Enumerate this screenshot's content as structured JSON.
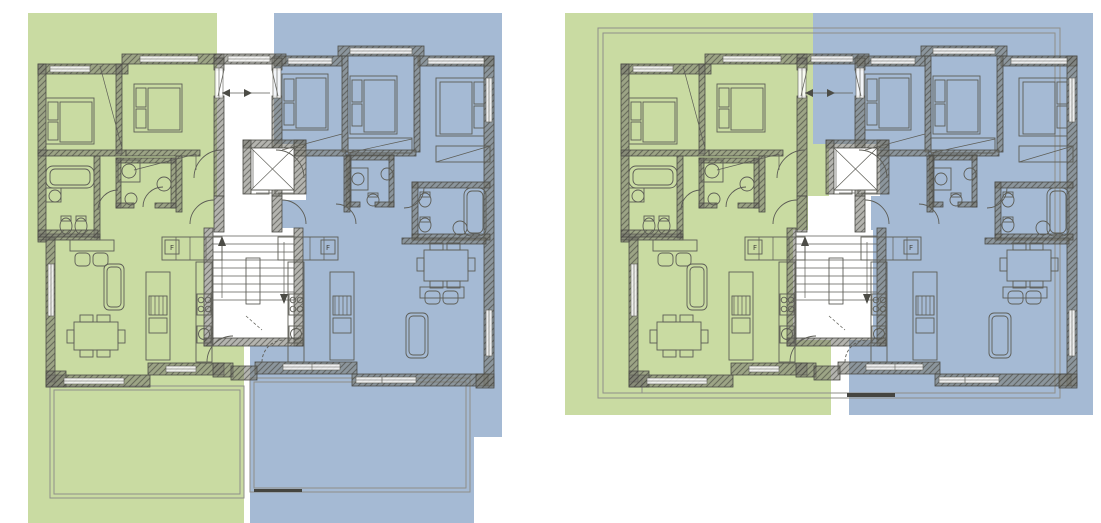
{
  "app": {
    "title": "residential floor plans — two units per level"
  },
  "palette": {
    "page_bg": "#ffffff",
    "unit_a_green": "#c9dba2",
    "unit_b_blue": "#a5bad4",
    "wall_hatch_base": "rgba(118,118,110,0.55)",
    "wall_hatch_line": "rgba(62,62,56,0.55)",
    "wall_stroke": "#4c4c46",
    "line": "#5d5d56",
    "outline_gray": "#8f8f89",
    "dark_line": "#454540",
    "window_fill": "rgba(255,255,255,0.85)",
    "text_color": "#44443f"
  },
  "labels": {
    "fridge": "F"
  },
  "plans": [
    {
      "name": "floor-plan-left",
      "dx": 0,
      "dy": 0,
      "overlay_green": "28,13 217,13 217,196 214,196 214,228 204,228 204,346 244,346 244,523 28,523",
      "overlay_blue": "274,13 502,13 502,437 474,437 474,523 250,523 250,346 303,346 303,228 282,228 282,200 306,200 306,144 274,144",
      "extras": {
        "outline_rects": [],
        "terrace_rects": [
          [
            50,
            386,
            194,
            112
          ],
          [
            54,
            390,
            186,
            104
          ],
          [
            250,
            378,
            220,
            114
          ],
          [
            254,
            382,
            212,
            106
          ]
        ],
        "dark_segments": [
          [
            254,
            489,
            48,
            3
          ]
        ],
        "lines": []
      }
    },
    {
      "name": "floor-plan-right",
      "dx": 583,
      "dy": 0,
      "overlay_green": "565,13 813,13 813,144 829,144 829,196 808,196 808,230 793,230 793,340 831,340 831,415 565,415",
      "overlay_blue": "813,13 1093,13 1093,415 849,415 849,340 873,340 873,230 871,230 871,196 880,196 880,144 813,144",
      "extras": {
        "outline_rects": [
          [
            598,
            28,
            462,
            370
          ],
          [
            603,
            33,
            452,
            360
          ]
        ],
        "terrace_rects": [],
        "dark_segments": [
          [
            847,
            393,
            48,
            4
          ]
        ],
        "lines": [
          [
            642,
            378,
            642,
            393
          ]
        ]
      }
    }
  ],
  "building": {
    "walls": [
      [
        38,
        64,
        90,
        10
      ],
      [
        122,
        54,
        102,
        10
      ],
      [
        214,
        54,
        72,
        10
      ],
      [
        274,
        56,
        68,
        10
      ],
      [
        338,
        46,
        86,
        10
      ],
      [
        418,
        56,
        76,
        10
      ],
      [
        484,
        56,
        10,
        330
      ],
      [
        38,
        64,
        8,
        178
      ],
      [
        46,
        238,
        9,
        144
      ],
      [
        46,
        375,
        104,
        12
      ],
      [
        46,
        371,
        20,
        16
      ],
      [
        148,
        363,
        76,
        12
      ],
      [
        213,
        363,
        20,
        14
      ],
      [
        255,
        362,
        102,
        12
      ],
      [
        231,
        366,
        26,
        14
      ],
      [
        352,
        374,
        136,
        12
      ],
      [
        476,
        374,
        18,
        14
      ],
      [
        214,
        58,
        10,
        12
      ],
      [
        214,
        96,
        10,
        100
      ],
      [
        272,
        58,
        10,
        12
      ],
      [
        272,
        96,
        10,
        100
      ],
      [
        214,
        196,
        10,
        36
      ],
      [
        272,
        196,
        10,
        36
      ],
      [
        204,
        228,
        9,
        118
      ],
      [
        294,
        228,
        9,
        118
      ],
      [
        204,
        338,
        99,
        8
      ],
      [
        243,
        140,
        63,
        8
      ],
      [
        243,
        140,
        8,
        54
      ],
      [
        294,
        140,
        12,
        54
      ],
      [
        116,
        64,
        6,
        90
      ],
      [
        38,
        150,
        88,
        6
      ],
      [
        126,
        150,
        74,
        6
      ],
      [
        94,
        156,
        6,
        82
      ],
      [
        38,
        234,
        62,
        6
      ],
      [
        116,
        158,
        60,
        5
      ],
      [
        116,
        158,
        5,
        50
      ],
      [
        171,
        158,
        5,
        50
      ],
      [
        116,
        203,
        18,
        5
      ],
      [
        155,
        203,
        21,
        5
      ],
      [
        38,
        230,
        60,
        7
      ],
      [
        176,
        156,
        6,
        56
      ],
      [
        342,
        56,
        6,
        96
      ],
      [
        414,
        56,
        6,
        96
      ],
      [
        280,
        150,
        66,
        6
      ],
      [
        348,
        150,
        68,
        6
      ],
      [
        346,
        155,
        48,
        5
      ],
      [
        346,
        155,
        5,
        52
      ],
      [
        389,
        155,
        5,
        52
      ],
      [
        346,
        202,
        14,
        5
      ],
      [
        375,
        202,
        19,
        5
      ],
      [
        412,
        182,
        78,
        6
      ],
      [
        412,
        182,
        6,
        58
      ],
      [
        412,
        234,
        78,
        6
      ],
      [
        402,
        238,
        84,
        6
      ],
      [
        344,
        156,
        6,
        56
      ]
    ],
    "windows": [
      [
        50,
        66,
        40,
        6
      ],
      [
        140,
        56,
        58,
        6
      ],
      [
        228,
        56,
        42,
        6
      ],
      [
        288,
        58,
        44,
        6
      ],
      [
        350,
        48,
        62,
        6
      ],
      [
        428,
        58,
        56,
        6
      ],
      [
        486,
        78,
        6,
        44
      ],
      [
        486,
        310,
        6,
        46
      ],
      [
        48,
        264,
        6,
        52
      ],
      [
        64,
        378,
        60,
        6
      ],
      [
        166,
        366,
        30,
        6
      ],
      [
        283,
        364,
        30,
        6
      ],
      [
        312,
        364,
        28,
        6
      ],
      [
        356,
        377,
        60,
        6
      ],
      [
        215,
        68,
        8,
        30
      ],
      [
        273,
        68,
        8,
        30
      ]
    ],
    "white_rects": [
      [
        251,
        148,
        43,
        42
      ],
      [
        246,
        258,
        14,
        46
      ]
    ],
    "rects": [
      [
        46,
        98,
        48,
        46
      ],
      [
        48,
        102,
        10,
        18
      ],
      [
        48,
        122,
        10,
        18
      ],
      [
        60,
        102,
        32,
        40
      ],
      [
        134,
        84,
        48,
        48
      ],
      [
        136,
        88,
        10,
        19
      ],
      [
        136,
        109,
        10,
        19
      ],
      [
        148,
        88,
        32,
        42
      ],
      [
        282,
        74,
        46,
        56
      ],
      [
        284,
        79,
        10,
        22
      ],
      [
        284,
        103,
        10,
        22
      ],
      [
        296,
        78,
        30,
        50
      ],
      [
        350,
        76,
        47,
        58
      ],
      [
        352,
        80,
        10,
        22
      ],
      [
        352,
        104,
        10,
        22
      ],
      [
        364,
        80,
        31,
        52
      ],
      [
        436,
        78,
        48,
        58
      ],
      [
        474,
        82,
        10,
        22
      ],
      [
        474,
        106,
        10,
        22
      ],
      [
        440,
        82,
        32,
        52
      ],
      [
        348,
        138,
        64,
        15
      ],
      [
        436,
        146,
        54,
        16
      ],
      [
        118,
        160,
        22,
        22
      ],
      [
        348,
        168,
        20,
        22
      ],
      [
        46,
        188,
        15,
        14
      ],
      [
        61,
        216,
        10,
        5
      ],
      [
        76,
        216,
        10,
        5
      ],
      [
        368,
        193,
        10,
        4
      ],
      [
        420,
        192,
        10,
        5
      ],
      [
        420,
        217,
        10,
        5
      ],
      [
        162,
        237,
        60,
        23
      ],
      [
        165,
        240,
        14,
        14
      ],
      [
        146,
        272,
        24,
        88
      ],
      [
        149,
        296,
        18,
        19
      ],
      [
        149,
        318,
        18,
        15
      ],
      [
        196,
        262,
        16,
        100
      ],
      [
        197,
        294,
        14,
        21
      ],
      [
        197,
        326,
        14,
        17
      ],
      [
        278,
        237,
        60,
        23
      ],
      [
        321,
        240,
        14,
        14
      ],
      [
        330,
        272,
        24,
        88
      ],
      [
        333,
        296,
        18,
        19
      ],
      [
        333,
        318,
        18,
        15
      ],
      [
        288,
        262,
        16,
        100
      ],
      [
        289,
        294,
        14,
        21
      ],
      [
        289,
        326,
        14,
        17
      ],
      [
        70,
        240,
        44,
        11
      ],
      [
        74,
        322,
        44,
        28
      ],
      [
        80,
        315,
        13,
        7
      ],
      [
        97,
        315,
        13,
        7
      ],
      [
        80,
        350,
        13,
        7
      ],
      [
        97,
        350,
        13,
        7
      ],
      [
        67,
        330,
        7,
        13
      ],
      [
        118,
        330,
        7,
        13
      ],
      [
        424,
        250,
        44,
        31
      ],
      [
        430,
        243,
        13,
        7
      ],
      [
        447,
        243,
        13,
        7
      ],
      [
        430,
        281,
        13,
        7
      ],
      [
        447,
        281,
        13,
        7
      ],
      [
        417,
        258,
        7,
        13
      ],
      [
        468,
        258,
        7,
        13
      ],
      [
        420,
        287,
        44,
        11
      ],
      [
        251,
        190,
        18,
        4
      ],
      [
        275,
        190,
        19,
        4
      ]
    ],
    "rrects": [
      [
        46,
        166,
        48,
        22,
        7
      ],
      [
        50,
        169,
        40,
        16,
        5
      ],
      [
        104,
        264,
        20,
        46,
        5
      ],
      [
        107,
        267,
        14,
        40,
        4
      ],
      [
        75,
        253,
        15,
        13,
        4
      ],
      [
        93,
        253,
        15,
        13,
        4
      ],
      [
        464,
        188,
        22,
        48,
        7
      ],
      [
        467,
        191,
        16,
        42,
        5
      ],
      [
        406,
        313,
        22,
        45,
        5
      ],
      [
        409,
        316,
        16,
        39,
        4
      ],
      [
        425,
        291,
        15,
        13,
        4
      ],
      [
        443,
        291,
        15,
        13,
        4
      ]
    ],
    "circles": [
      [
        129,
        171,
        7
      ],
      [
        55,
        196,
        6
      ],
      [
        164,
        184,
        7
      ],
      [
        201,
        300,
        2.8
      ],
      [
        208,
        300,
        2.8
      ],
      [
        201,
        309,
        2.8
      ],
      [
        208,
        309,
        2.8
      ],
      [
        204,
        334,
        5.5
      ],
      [
        358,
        179,
        6
      ],
      [
        387,
        174,
        6
      ],
      [
        293,
        300,
        2.8
      ],
      [
        300,
        300,
        2.8
      ],
      [
        293,
        309,
        2.8
      ],
      [
        300,
        309,
        2.8
      ],
      [
        296,
        334,
        5.5
      ],
      [
        460,
        228,
        7
      ]
    ],
    "ellipses": [
      [
        66,
        226,
        6,
        8
      ],
      [
        81,
        226,
        6,
        8
      ],
      [
        131,
        199,
        6,
        6
      ],
      [
        373,
        200,
        6,
        6
      ],
      [
        425,
        200,
        6,
        7
      ],
      [
        425,
        225,
        6,
        7
      ]
    ],
    "lines": [
      [
        213,
        236,
        294,
        236
      ],
      [
        213,
        244,
        294,
        244
      ],
      [
        213,
        252,
        294,
        252
      ],
      [
        213,
        260,
        294,
        260
      ],
      [
        213,
        268,
        294,
        268
      ],
      [
        213,
        276,
        294,
        276
      ],
      [
        213,
        284,
        294,
        284
      ],
      [
        213,
        292,
        294,
        292
      ],
      [
        213,
        300,
        294,
        300
      ],
      [
        251,
        148,
        294,
        190
      ],
      [
        294,
        148,
        251,
        190
      ],
      [
        253,
        150,
        253,
        188
      ],
      [
        256,
        193,
        272,
        193
      ],
      [
        278,
        193,
        294,
        193
      ],
      [
        222,
        93,
        270,
        93
      ],
      [
        176,
        237,
        176,
        260
      ],
      [
        190,
        237,
        190,
        260
      ],
      [
        206,
        237,
        206,
        260
      ],
      [
        294,
        237,
        294,
        260
      ],
      [
        310,
        237,
        310,
        260
      ],
      [
        324,
        237,
        324,
        260
      ],
      [
        151,
        296,
        151,
        315
      ],
      [
        155,
        296,
        155,
        315
      ],
      [
        159,
        296,
        159,
        315
      ],
      [
        163,
        296,
        163,
        315
      ],
      [
        167,
        296,
        167,
        315
      ],
      [
        335,
        296,
        335,
        315
      ],
      [
        339,
        296,
        339,
        315
      ],
      [
        343,
        296,
        343,
        315
      ],
      [
        347,
        296,
        347,
        315
      ],
      [
        351,
        296,
        351,
        315
      ],
      [
        100,
        66,
        122,
        148
      ],
      [
        134,
        170,
        196,
        154
      ],
      [
        196,
        154,
        196,
        170
      ],
      [
        282,
        150,
        342,
        134
      ],
      [
        342,
        134,
        342,
        150
      ],
      [
        348,
        153,
        412,
        139
      ],
      [
        436,
        162,
        490,
        146
      ],
      [
        218,
        96,
        224,
        70
      ],
      [
        278,
        96,
        272,
        70
      ],
      [
        222,
        298,
        222,
        242
      ],
      [
        284,
        242,
        284,
        298
      ],
      [
        382,
        377,
        382,
        383
      ]
    ],
    "dashed_lines": [
      [
        246,
        316,
        262,
        330
      ]
    ],
    "polys": [
      [
        218,
        246,
        226,
        246,
        222,
        236
      ],
      [
        280,
        294,
        288,
        294,
        284,
        304
      ],
      [
        222,
        93,
        230,
        89,
        230,
        97
      ],
      [
        244,
        89,
        252,
        93,
        244,
        97
      ]
    ],
    "arcs": [
      {
        "d": "M222,150 A28,28 0 0 0 194,178",
        "dashed": false
      },
      {
        "d": "M276,150 A28,28 0 0 1 304,178",
        "dashed": false
      },
      {
        "d": "M214,200 A24,24 0 0 0 190,224",
        "dashed": false
      },
      {
        "d": "M282,200 A24,24 0 0 1 306,224",
        "dashed": false
      },
      {
        "d": "M207,362 A26,26 0 0 1 233,336",
        "dashed": false
      },
      {
        "d": "M262,362 A22,22 0 0 1 284,340",
        "dashed": true
      },
      {
        "d": "M98,210 A20,20 0 0 1 118,190",
        "dashed": false
      },
      {
        "d": "M143,207 A20,20 0 0 1 163,187",
        "dashed": false
      },
      {
        "d": "M356,224 A20,20 0 0 0 336,204",
        "dashed": false
      },
      {
        "d": "M404,208 A20,20 0 0 0 424,188",
        "dashed": false
      }
    ],
    "texts": [
      {
        "x": 172,
        "y": 250,
        "key": "fridge"
      },
      {
        "x": 328,
        "y": 250,
        "key": "fridge"
      }
    ]
  }
}
